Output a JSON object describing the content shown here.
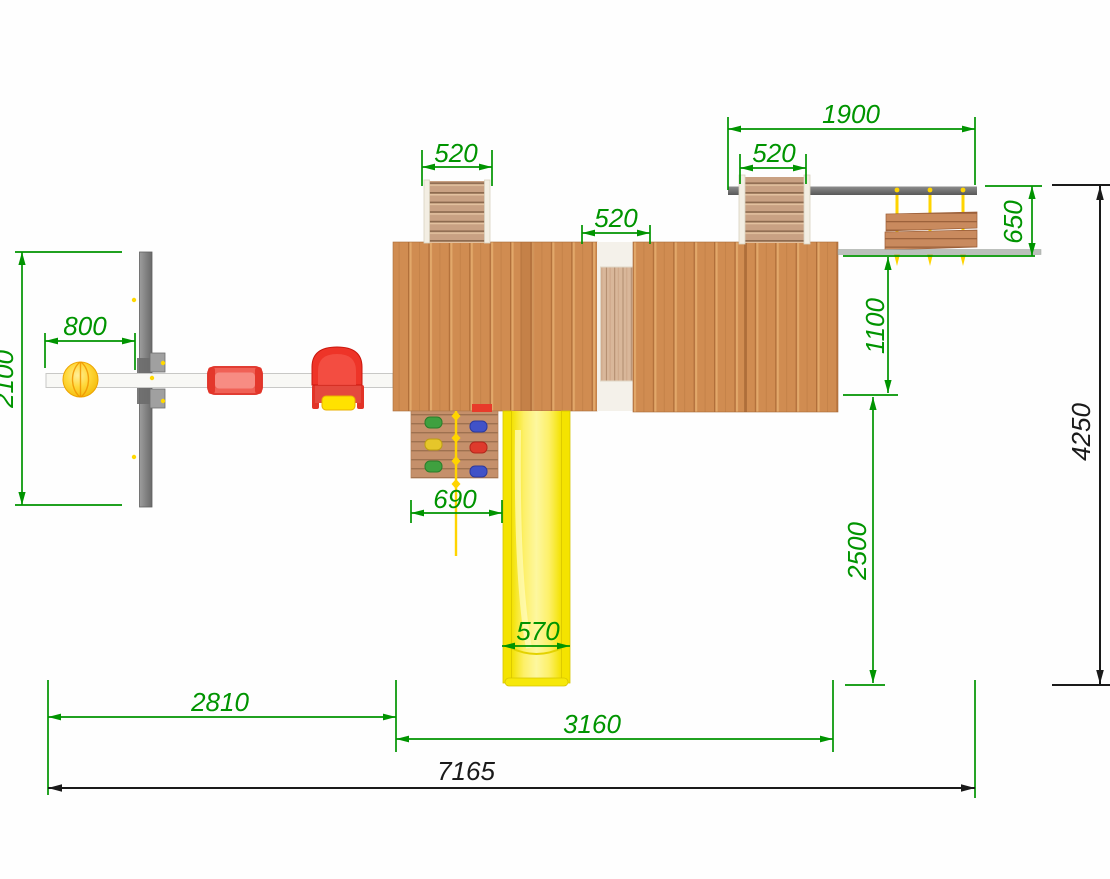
{
  "drawing": {
    "title": "playground-top-view-plan",
    "units_shown": false,
    "dims": {
      "ladder_left_width": "520",
      "bridge_width": "520",
      "ladder_right_width": "520",
      "cantilever_span": "1900",
      "rings_depth": "650",
      "rings_offset": "1100",
      "swing_seat_offset": "800",
      "swing_frame_depth": "2100",
      "climbing_wall_width": "690",
      "slide_width": "570",
      "rings_drop": "2500",
      "swing_bay_length": "2810",
      "tower_bay_length": "3160",
      "overall_length": "7165",
      "overall_depth": "4250"
    },
    "colors": {
      "dimension_green": "#009400",
      "dimension_black": "#1a1a1a",
      "deck_wood": "#d08c51",
      "bridge_wood": "#d9b79a",
      "ladder_wood": "#c9a183",
      "slide_yellow": "#f8e500",
      "rope_yellow": "#ffd400",
      "seat_red": "#ea4034",
      "frame_gray": "#7b7b7b",
      "swing_beam_white": "#f8f8f5",
      "hold_green": "#3fa03f",
      "hold_blue": "#4052c8",
      "hold_yellow": "#e6c62a",
      "hold_red": "#de3a2c"
    }
  }
}
